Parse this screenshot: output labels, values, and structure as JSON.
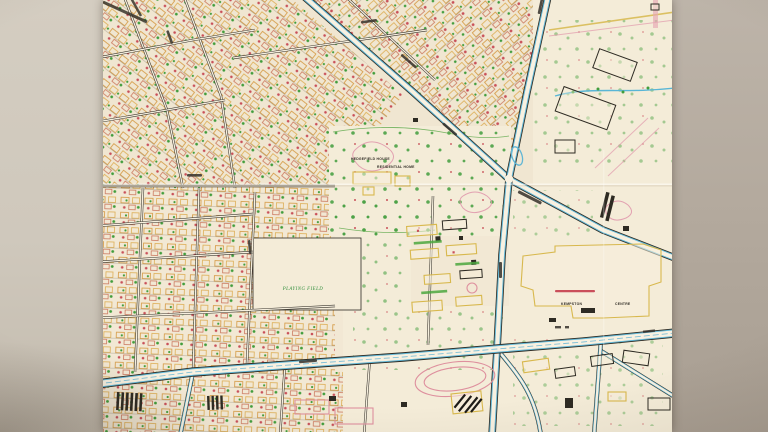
{
  "scene": {
    "type": "photograph of a folded paper street map on a grey-beige surface",
    "backdrop": {
      "left_color": "#cfc8bc",
      "right_color": "#b3a99d"
    },
    "paper": {
      "base_color": "#f2e8d3"
    },
    "palette": {
      "road_blue": "#5fb6d6",
      "ink_black": "#2b281f",
      "building_orange": "#d6983e",
      "building_yellow": "#dfae52",
      "outline_yellow": "#d9b84a",
      "dot_red": "#cc4f58",
      "tree_green": "#3f9e3a",
      "contour_pink": "#e299ad",
      "road_white": "#f8f1e0"
    }
  },
  "map": {
    "labels": {
      "hedgefield_house": "HEDGEFIELD HOUSE",
      "residential_home": "RESIDENTIAL HOME",
      "kempston": "KEMPSTON",
      "centre": "CENTRE",
      "playing_field": "PLAYING FIELD"
    }
  }
}
